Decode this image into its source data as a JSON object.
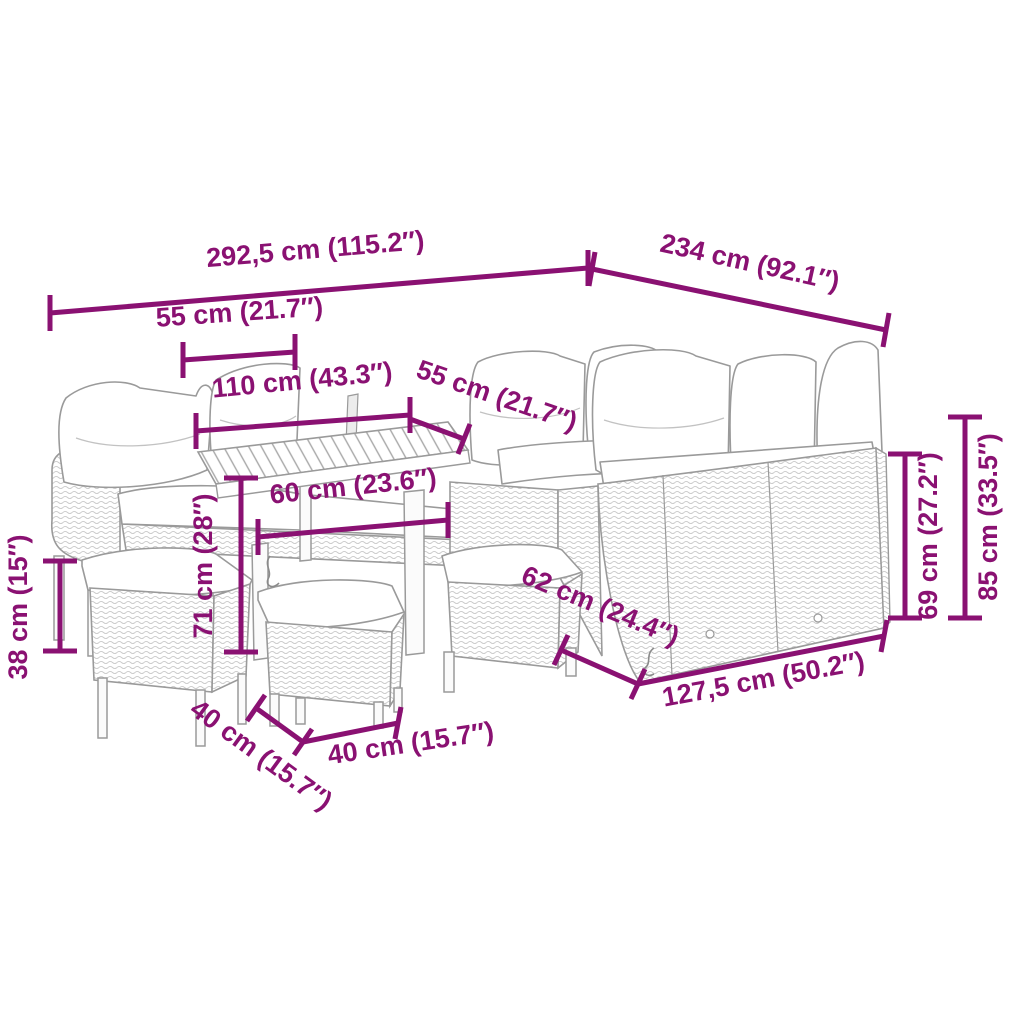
{
  "diagram": {
    "kind": "product-dimension-diagram",
    "subject": "poly rattan garden lounge set with corner sofa, dining table and stools",
    "background_color": "#ffffff",
    "dimension_color": "#8a1172",
    "drawing_line_color": "#9a9a9a",
    "units": "centimetres with inches in parentheses"
  },
  "labels": [
    {
      "id": "overall-width",
      "text": "292,5 cm (115.2″)",
      "value_cm": "292,5",
      "value_in": "115.2"
    },
    {
      "id": "overall-depth",
      "text": "234 cm (92.1″)",
      "value_cm": "234",
      "value_in": "92.1"
    },
    {
      "id": "arm-section-width",
      "text": "55 cm (21.7″)",
      "value_cm": "55",
      "value_in": "21.7"
    },
    {
      "id": "bench-width",
      "text": "110 cm (43.3″)",
      "value_cm": "110",
      "value_in": "43.3"
    },
    {
      "id": "corner-seat-width",
      "text": "55 cm (21.7″)",
      "value_cm": "55",
      "value_in": "21.7"
    },
    {
      "id": "table-top-width",
      "text": "60 cm (23.6″)",
      "value_cm": "60",
      "value_in": "23.6"
    },
    {
      "id": "table-height",
      "text": "71 cm (28″)",
      "value_cm": "71",
      "value_in": "28"
    },
    {
      "id": "stool-height",
      "text": "38 cm (15″)",
      "value_cm": "38",
      "value_in": "15"
    },
    {
      "id": "stool-depth",
      "text": "40 cm (15.7″)",
      "value_cm": "40",
      "value_in": "15.7"
    },
    {
      "id": "stool-width",
      "text": "40 cm (15.7″)",
      "value_cm": "40",
      "value_in": "15.7"
    },
    {
      "id": "seat-depth",
      "text": "62 cm (24.4″)",
      "value_cm": "62",
      "value_in": "24.4"
    },
    {
      "id": "right-section-length",
      "text": "127,5 cm (50.2″)",
      "value_cm": "127,5",
      "value_in": "50.2"
    },
    {
      "id": "back-rest-height",
      "text": "69 cm (27.2″)",
      "value_cm": "69",
      "value_in": "27.2"
    },
    {
      "id": "overall-height",
      "text": "85 cm (33.5″)",
      "value_cm": "85",
      "value_in": "33.5"
    }
  ]
}
